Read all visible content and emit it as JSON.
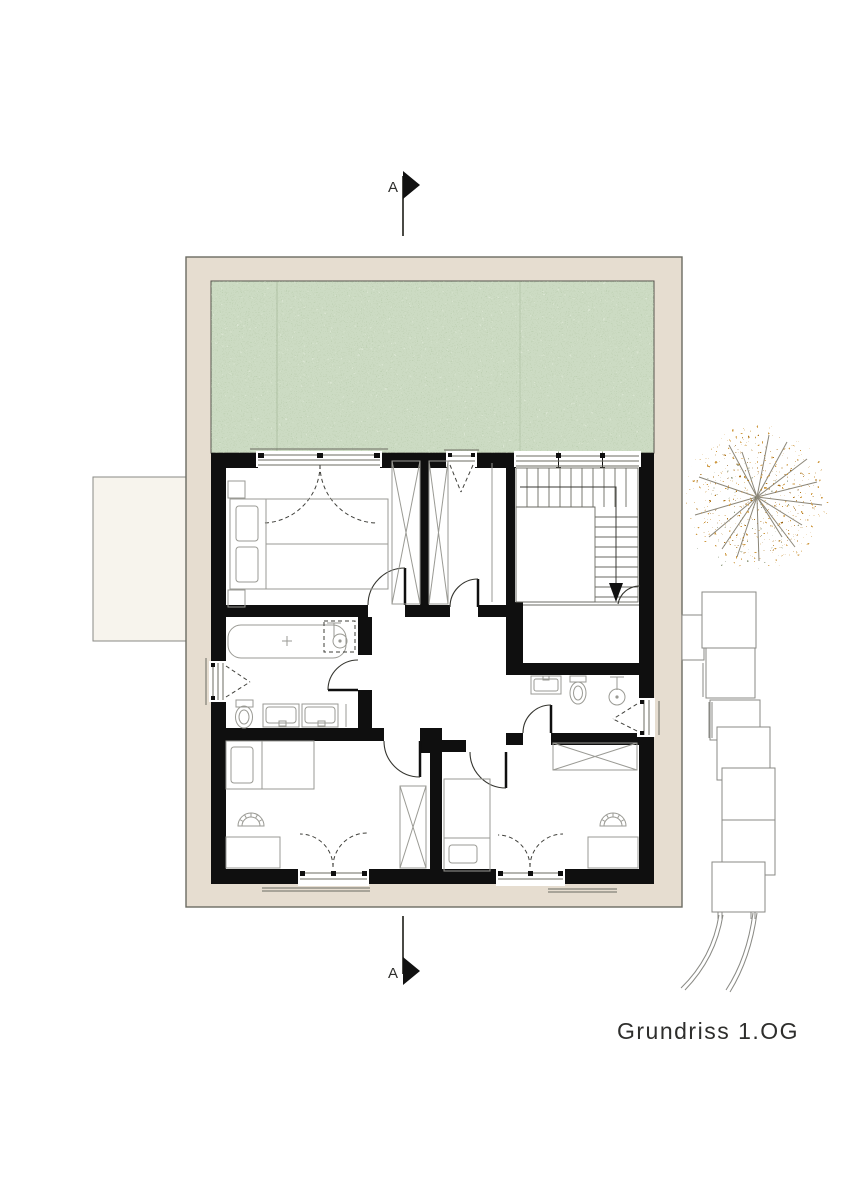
{
  "page": {
    "width": 848,
    "height": 1200,
    "background": "#ffffff"
  },
  "drawing": {
    "title": "Grundriss 1.OG",
    "section_marker_top": "A",
    "section_marker_bottom": "A"
  },
  "palette": {
    "wall": "#0f0f0f",
    "band": "#e6ddd0",
    "green": "#ccdbc3",
    "greenLine": "#9fb292",
    "furn": "#9a9a94",
    "stair": "#6a6a63",
    "dash": "#3f3f3a",
    "outline": "#6b6b62",
    "label": "#2e2e2c",
    "treeOrange": "#cf9a43",
    "treeDeep": "#b0761f",
    "treeBrown": "#8a5a14",
    "treeGreen": "#6d7a55",
    "treeBranch": "#8b8678",
    "neighbor": "#8a8a85",
    "cream": "#f7f4ed"
  },
  "symbols": [
    "section-marker",
    "green-roof",
    "double-bed",
    "single-bed",
    "bathtub",
    "shower",
    "toilet",
    "sink",
    "vanity",
    "wardrobe",
    "desk",
    "chair",
    "stairs",
    "door-swing",
    "window",
    "tree",
    "neighbor-terraces"
  ]
}
